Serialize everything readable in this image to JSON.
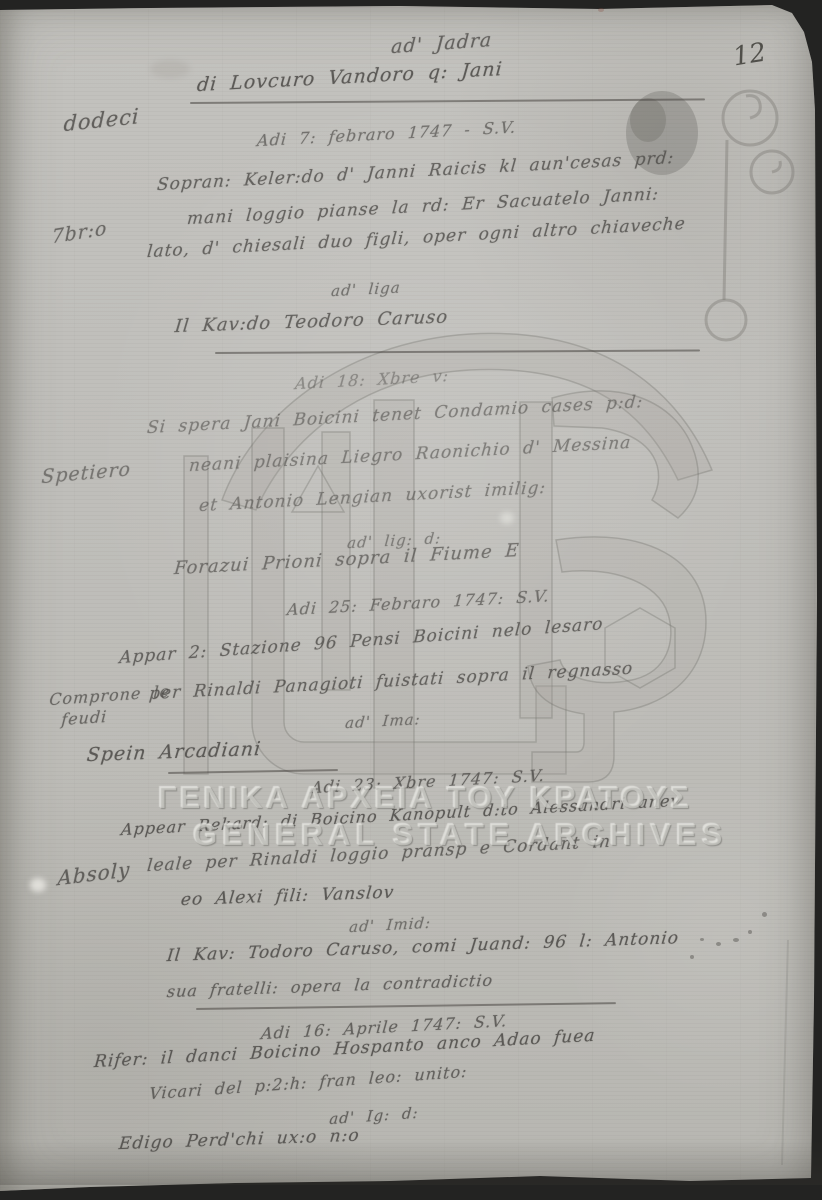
{
  "page": {
    "number": "12"
  },
  "watermark": {
    "greek": "ΓΕΝΙΚΑ ΑΡΧΕΙΑ ΤΟΥ ΚΡΑΤΟΥΣ",
    "latin": "GENERAL STATE ARCHIVES",
    "logo": "gak-monogram"
  },
  "heading": {
    "title": "ad' Jadra",
    "subtitle": "di Lovcuro Vandoro q: Jani"
  },
  "margin_notes": {
    "n0": "dodeci",
    "n1": "7br:o",
    "n2": "Spetiero",
    "n3": "Comprone le",
    "n4": "feudi",
    "n5": "Absoly"
  },
  "lines": [
    {
      "text": "Adi 7: febraro 1747 - S.V."
    },
    {
      "text": "Sopran: Keler:do d' Janni Raicis kl aun'cesas prd:"
    },
    {
      "text": "mani loggio pianse la rd: Er Sacuatelo Janni:"
    },
    {
      "text": "lato, d' chiesali duo figli, oper ogni altro chiaveche"
    },
    {
      "text": "ad' liga"
    },
    {
      "text": "Il Kav:do Teodoro Caruso"
    },
    {
      "text": "Adi 18: Xbre v:"
    },
    {
      "text": "Si spera Jani Boicini tenet Condamio cases p:d:"
    },
    {
      "text": "neani plaisina Liegro Raonichio d' Messina"
    },
    {
      "text": "et Antonio Lengian uxorist imilig:"
    },
    {
      "text": "ad' lig: d:"
    },
    {
      "text": "Forazui Prioni sopra il Fiume E"
    },
    {
      "text": "Adi 25: Febraro 1747: S.V."
    },
    {
      "text": "Appar 2: Stazione 96 Pensi Boicini nelo lesaro"
    },
    {
      "text": "per Rinaldi Panagioti fuistati sopra il regnasso"
    },
    {
      "text": "ad' Ima:"
    },
    {
      "text": "Spein Arcadiani"
    },
    {
      "text": "Adi 23: Xbre 1747: S.V."
    },
    {
      "text": "Appear Rekard: di Boicino Kanopult d:to Alessandri anev"
    },
    {
      "text": "leale per Rinaldi loggio pransp e Cordant in"
    },
    {
      "text": "eo Alexi fili: Vanslov"
    },
    {
      "text": "ad' Imid:"
    },
    {
      "text": "Il Kav: Todoro Caruso, comi Juand: 96 l: Antonio"
    },
    {
      "text": "sua fratelli: opera la contradictio"
    },
    {
      "text": "Adi 16: Aprile 1747: S.V."
    },
    {
      "text": "Rifer: il danci Boicino Hospanto anco Adao fuea"
    },
    {
      "text": "Vicari del p:2:h: fran leo: unito:"
    },
    {
      "text": "ad' Ig: d:"
    },
    {
      "text": "Edigo Perd'chi ux:o n:o"
    }
  ],
  "colors": {
    "paper": "#c0bfbb",
    "ink": "#4e4c49",
    "watermark_text": "#e2e1dc",
    "background": "#232322"
  }
}
